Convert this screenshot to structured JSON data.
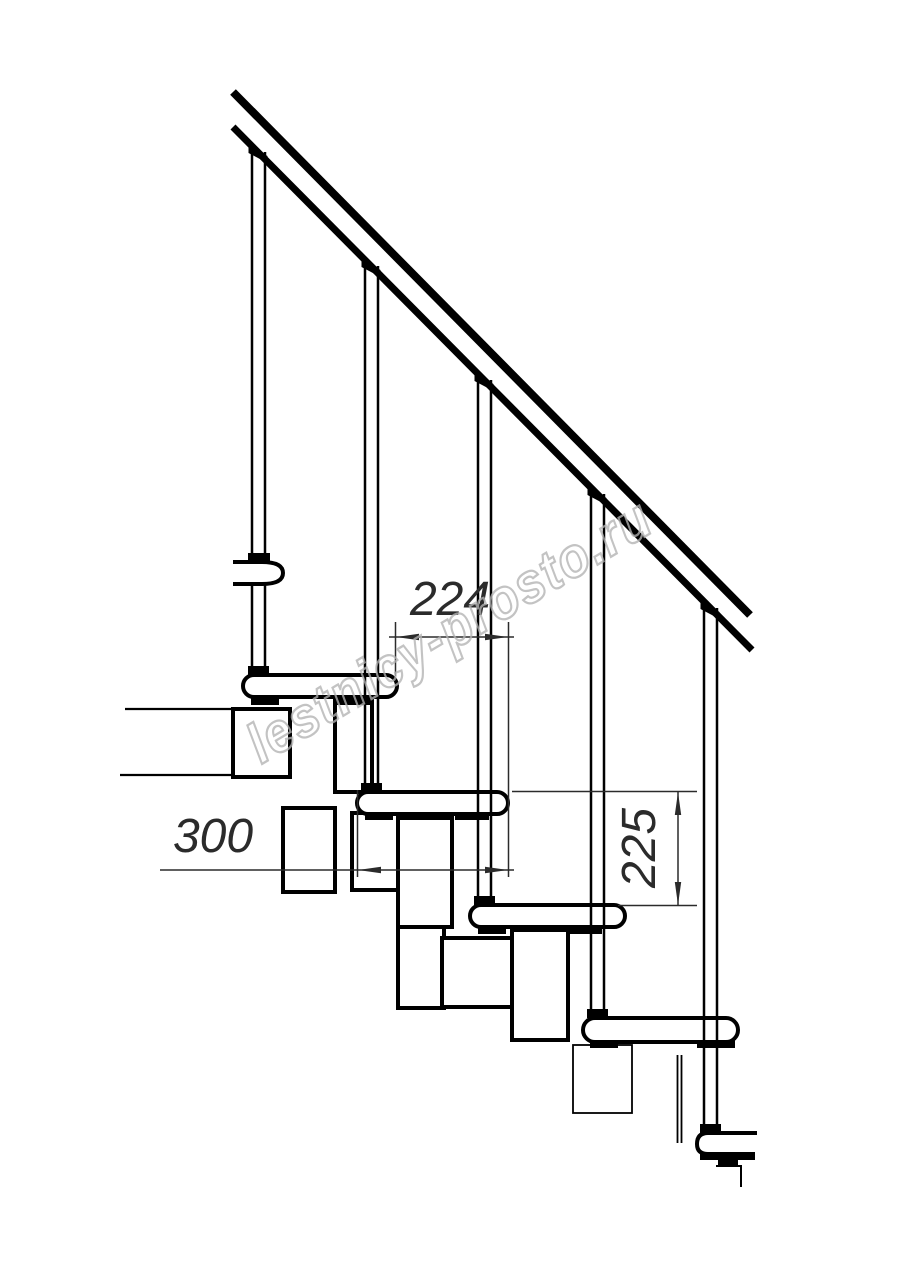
{
  "page": {
    "background": "#ffffff",
    "width": 914,
    "height": 1280
  },
  "drawing": {
    "type": "modular-staircase-side-view",
    "line_color": "#000000",
    "fill_color": "#ffffff",
    "dim_color": "#2b2b2b",
    "watermark_color": "#b3b3b3",
    "dimensions": {
      "going": "224",
      "tread_depth": "300",
      "rise": "225"
    },
    "watermark": "lestnicy-prosto.ru"
  }
}
